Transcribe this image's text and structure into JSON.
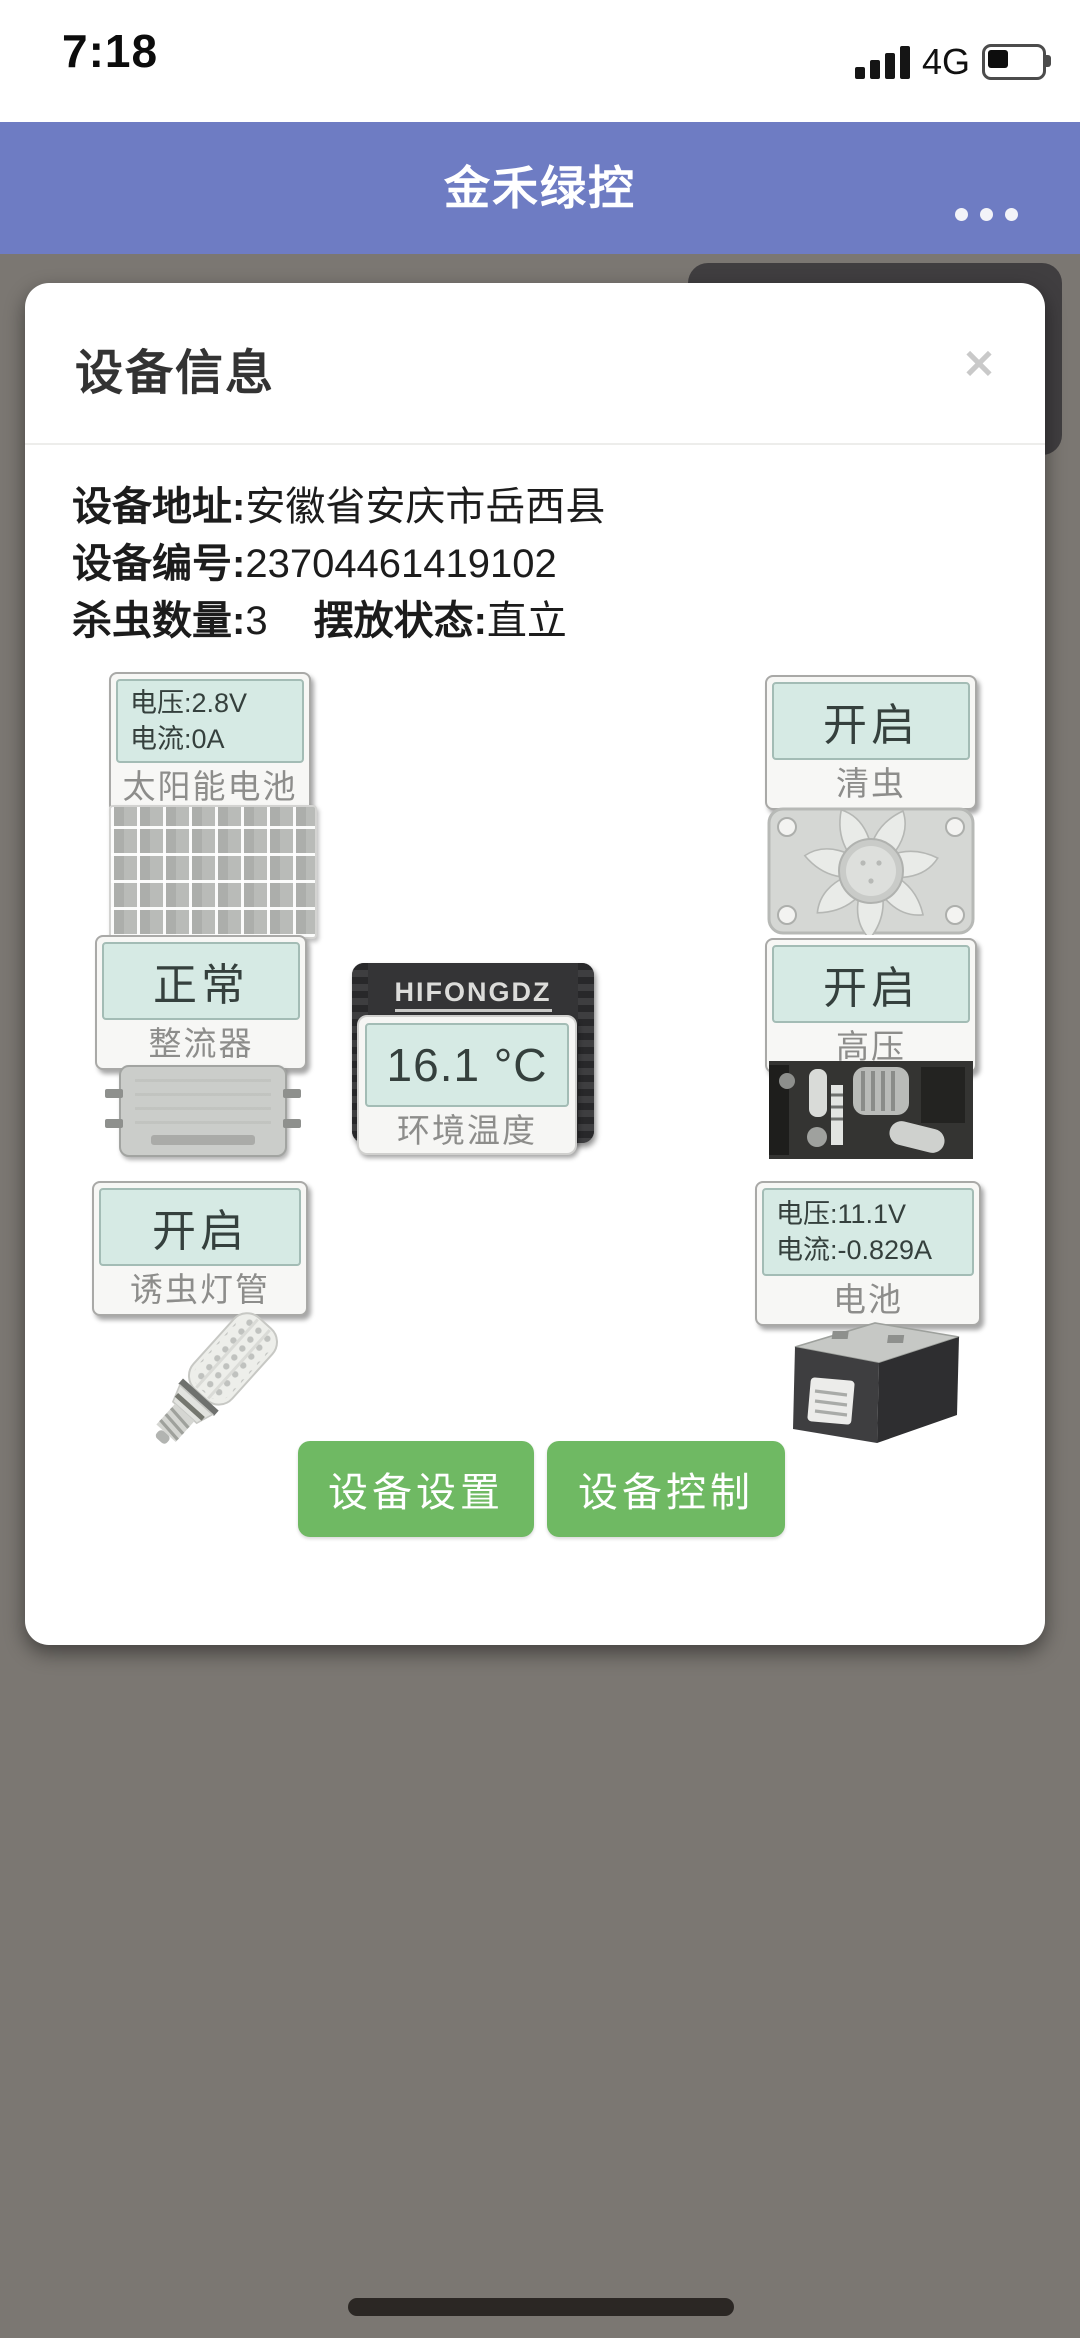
{
  "status_bar": {
    "time": "7:18",
    "network": "4G"
  },
  "header": {
    "title": "金禾绿控"
  },
  "modal": {
    "title": "设备信息",
    "close_glyph": "✕",
    "info": {
      "address_label": "设备地址:",
      "address_value": "安徽省安庆市岳西县",
      "device_id_label": "设备编号:",
      "device_id_value": "23704461419102",
      "insect_count_label": "杀虫数量:",
      "insect_count_value": "3",
      "placement_label": "摆放状态:",
      "placement_value": "直立"
    },
    "devices": {
      "solar_panel": {
        "voltage": "电压:2.8V",
        "current": "电流:0A",
        "label": "太阳能电池"
      },
      "insect_cleaner": {
        "status": "开启",
        "label": "清虫"
      },
      "rectifier": {
        "status": "正常",
        "label": "整流器"
      },
      "temperature": {
        "brand": "HIFONGDZ",
        "brand_sub": "Programmable",
        "value": "16.1 °C",
        "label": "环境温度"
      },
      "high_voltage": {
        "status": "开启",
        "label": "高压"
      },
      "lure_lamp": {
        "status": "开启",
        "label": "诱虫灯管"
      },
      "battery": {
        "voltage": "电压:11.1V",
        "current": "电流:-0.829A",
        "label": "电池"
      }
    },
    "buttons": {
      "settings": "设备设置",
      "control": "设备控制"
    }
  },
  "colors": {
    "header_bg": "#6e7cc3",
    "status_panel_teal": "#d6eae4",
    "button_green": "#6fb963",
    "overlay_gray": "#7b7772"
  }
}
